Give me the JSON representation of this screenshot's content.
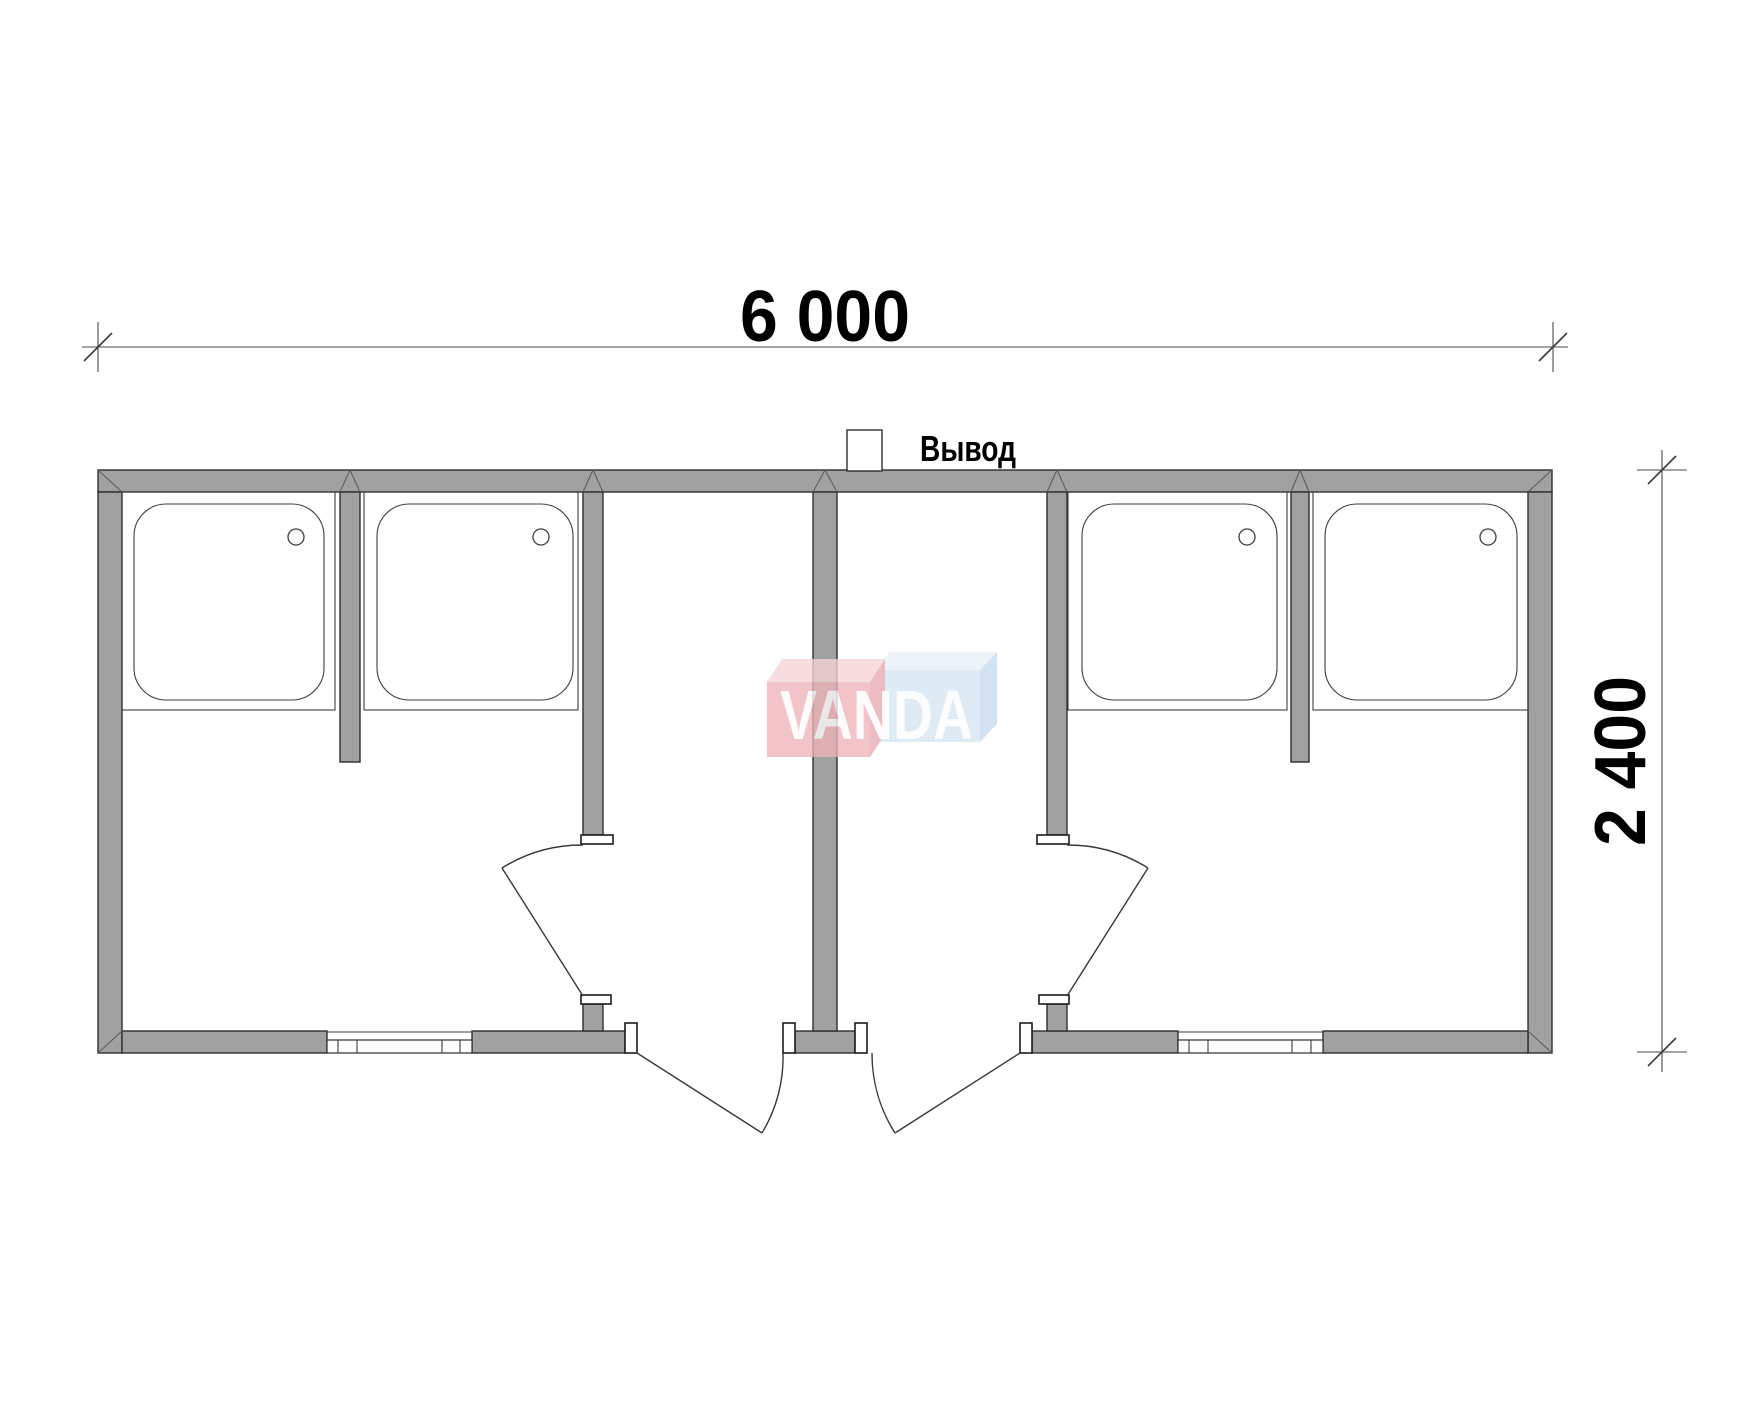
{
  "drawing": {
    "type": "floor-plan",
    "dimensions": {
      "width_label": "6 000",
      "height_label": "2 400"
    },
    "labels": {
      "outlet": "Вывод"
    },
    "watermark": {
      "text": "VANDA"
    },
    "colors": {
      "wall_fill": "#a1a1a1",
      "background": "#ffffff",
      "line": "#3d3d3d",
      "logo_red_front": "#efb3b9",
      "logo_red_top": "#f6d3d8",
      "logo_red_side": "#e9a9b1",
      "logo_blue_front": "#d6e5f2",
      "logo_blue_top": "#e7f0f8",
      "logo_blue_side": "#c9dcee",
      "logo_text": "#ffffff"
    },
    "rooms": {
      "shower_tray_count": 4,
      "interior_door_count": 2,
      "exterior_door_count": 2,
      "window_count": 2
    }
  }
}
